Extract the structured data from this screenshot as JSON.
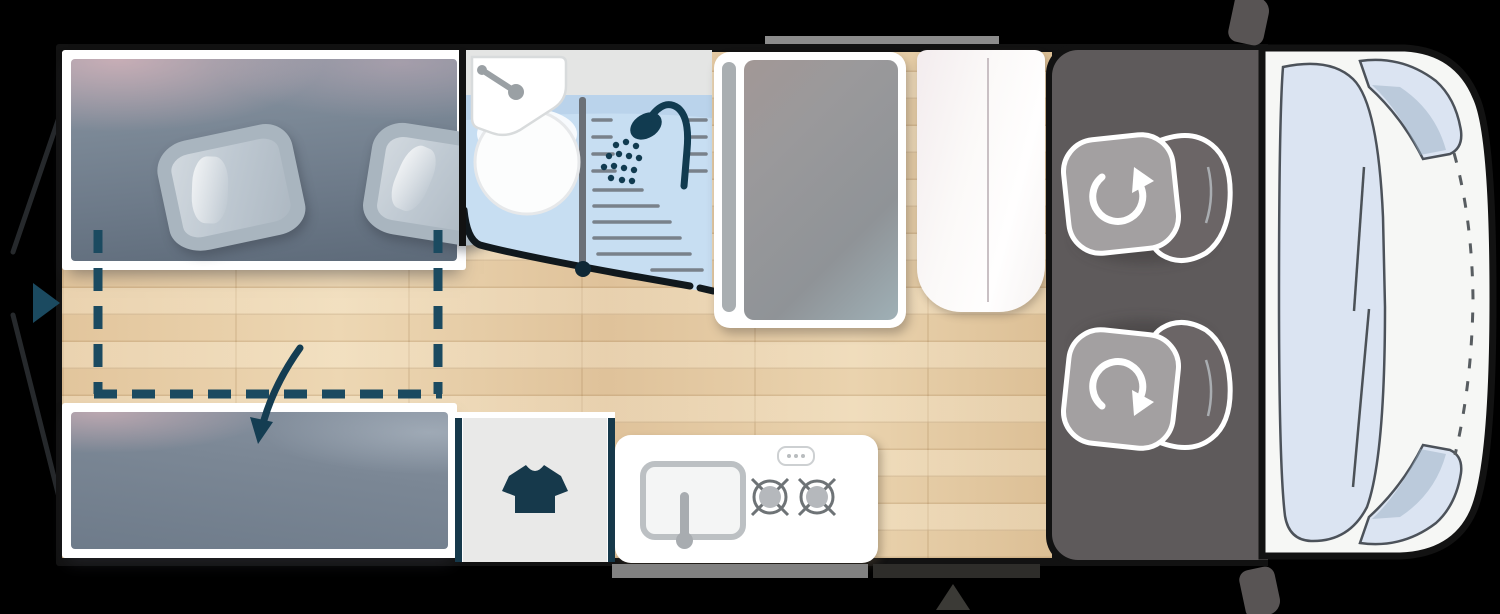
{
  "figure": {
    "kind": "campervan-floorplan-top-view",
    "orientation": "rear-left_front-right",
    "text_content": "none"
  },
  "zones": [
    {
      "id": "rear-bed",
      "name": "rear transverse bed with two pillows"
    },
    {
      "id": "bed-extension",
      "name": "dashed pull-out bed extension zone with curved arrow"
    },
    {
      "id": "rear-bench",
      "name": "lower bench / second bed cushion"
    },
    {
      "id": "washroom",
      "name": "wet bathroom with washbasin, shower screen and shower head"
    },
    {
      "id": "swivel-panel",
      "name": "gray swivel wall / shower panel with white frame"
    },
    {
      "id": "wardrobe",
      "name": "white wardrobe cabinet with double-door seam"
    },
    {
      "id": "closet",
      "name": "clothes closet marked with t-shirt icon"
    },
    {
      "id": "kitchen",
      "name": "kitchen block with sink and two-burner hob"
    },
    {
      "id": "cab",
      "name": "driver cab with two swivel seats"
    },
    {
      "id": "van-front",
      "name": "van nose with windshield, corner windows, mirrors and dashed hood line"
    },
    {
      "id": "rear-doors",
      "name": "open rear barn doors shown as diagonal lines"
    },
    {
      "id": "entry",
      "name": "sliding-door rail (top) and entry steps with position triangle (bottom)"
    }
  ],
  "icons": [
    "shower-head-icon",
    "tshirt-icon",
    "swivel-arrow-cw-icon",
    "swivel-arrow-ccw-icon",
    "faucet-icon",
    "burner-icon",
    "direction-triangle-icon",
    "extension-arrow-icon"
  ],
  "palette": {
    "bg": "#000000",
    "outline": "#121212",
    "white": "#ffffff",
    "wood_base": "#e5cba4",
    "navy": "#16394b",
    "teal_accent": "#1b4a60",
    "wet_floor": "#c7def2",
    "wet_floor_shade": "#aecbe6",
    "counter_gray": "#e4e5e4",
    "divider_gray": "#6b7077",
    "drain_gray": "#79818a",
    "panel_pill": "#a9aeb1",
    "seam": "#c9c0c4",
    "cab_gray": "#5e5a5b",
    "seat_light": "#a3a0a1",
    "seat_back": "#6b6566",
    "front_body": "#f6f7f5",
    "window_blue": "#dbe4f2",
    "window_line": "#4c525a",
    "bar_gray": "#8c8c8c",
    "step_light": "#818181",
    "step_dark": "#2e2d2a",
    "tri_gray": "#3b3a36",
    "mirror_gray": "#585454",
    "pillow_edge": "#a9b5bf",
    "cushion_slate": "#7a8795",
    "door_line": "#26292c",
    "arrow_navy": "#143d52"
  }
}
